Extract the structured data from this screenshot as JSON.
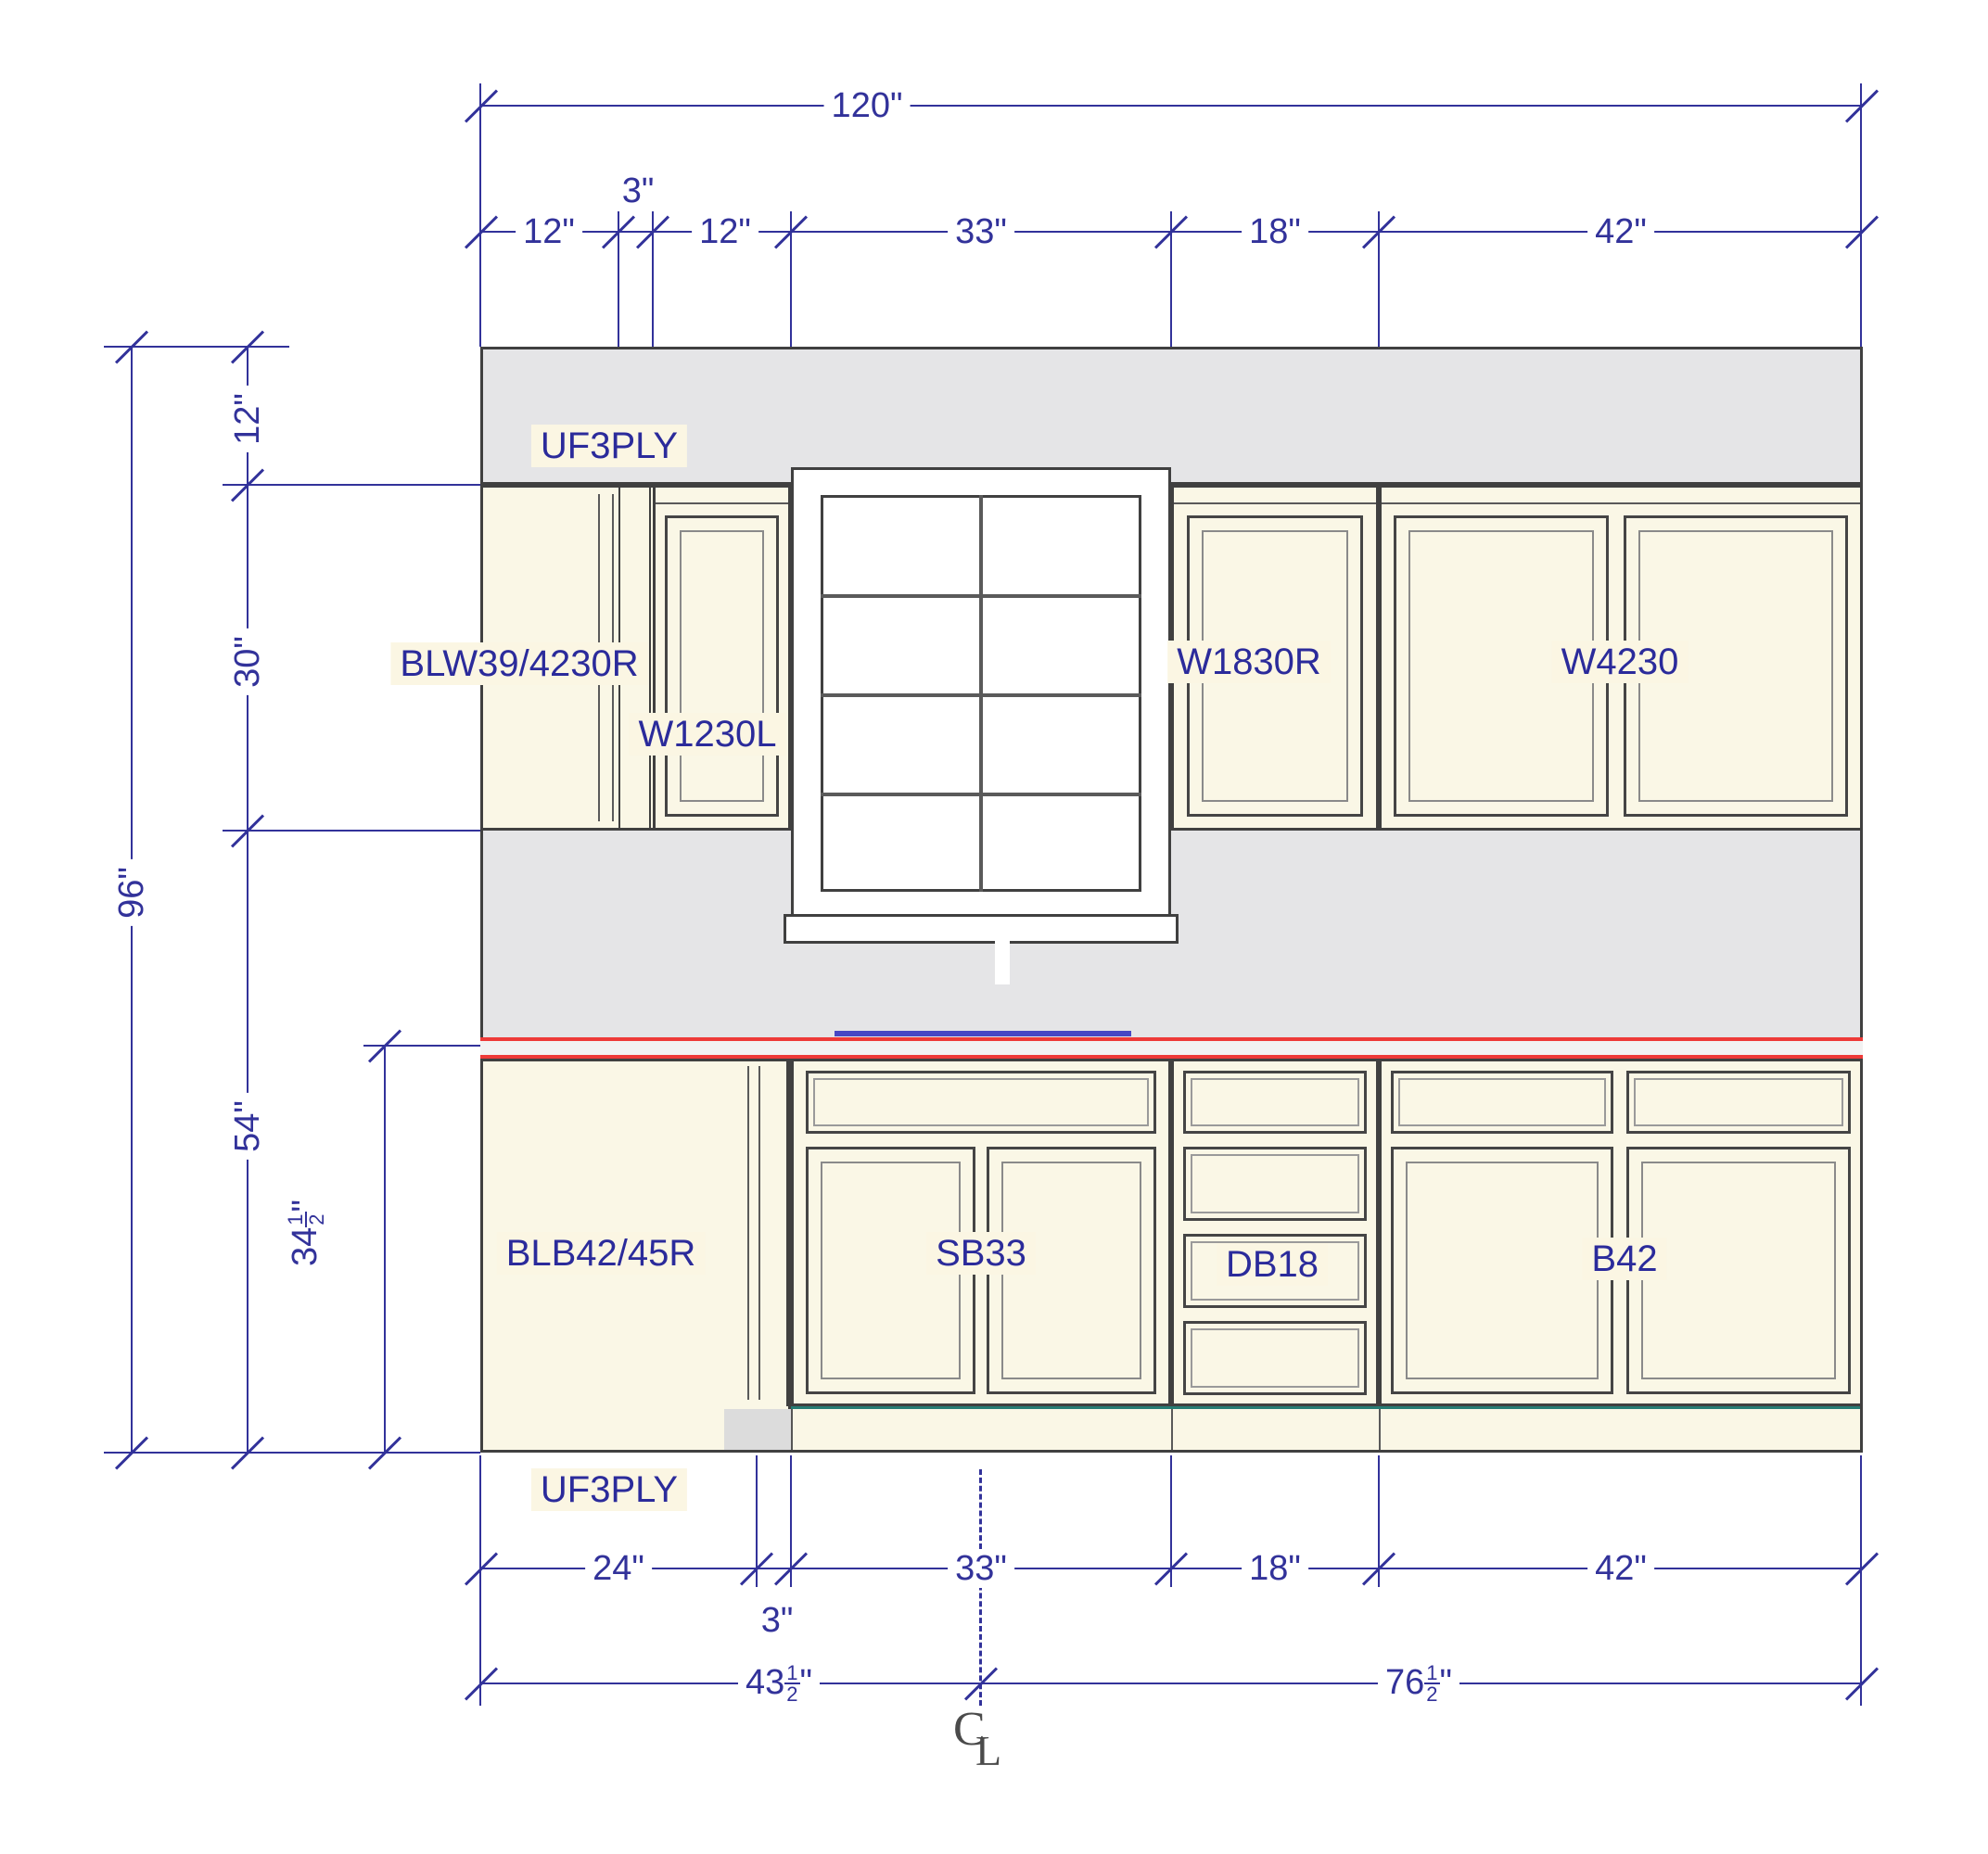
{
  "drawing": {
    "type": "kitchen-cabinet-elevation"
  },
  "colors": {
    "dimension_blue": "#32329a",
    "label_blue": "#2b2b9b",
    "cabinet_line": "#404040",
    "cabinet_fill": "#faf7e6",
    "soffit_gray": "#e5e5e7",
    "counter_red": "#ee3a38",
    "toekick_teal": "#267c74",
    "sink_blue": "#4747c4"
  },
  "labels": {
    "uf3ply_top": "UF3PLY",
    "blw": "BLW39/4230R",
    "w1230l": "W1230L",
    "w1830r": "W1830R",
    "w4230": "W4230",
    "blb": "BLB42/45R",
    "sb33": "SB33",
    "db18": "DB18",
    "b42": "B42",
    "uf3ply_bottom": "UF3PLY"
  },
  "dims": {
    "top_total": "120\"",
    "t12a": "12\"",
    "t3": "3\"",
    "t12b": "12\"",
    "t33": "33\"",
    "t18": "18\"",
    "t42": "42\"",
    "l96": "96\"",
    "l12": "12\"",
    "l30": "30\"",
    "l54": "54\"",
    "b24": "24\"",
    "b3": "3\"",
    "b33": "33\"",
    "b18": "18\"",
    "b42": "42\"",
    "frac34": {
      "whole": "34",
      "num": "1",
      "den": "2",
      "suffix": "\""
    },
    "frac43": {
      "whole": "43",
      "num": "1",
      "den": "2",
      "suffix": "\""
    },
    "frac76": {
      "whole": "76",
      "num": "1",
      "den": "2",
      "suffix": "\""
    },
    "centerline_c": "C",
    "centerline_l": "L"
  }
}
